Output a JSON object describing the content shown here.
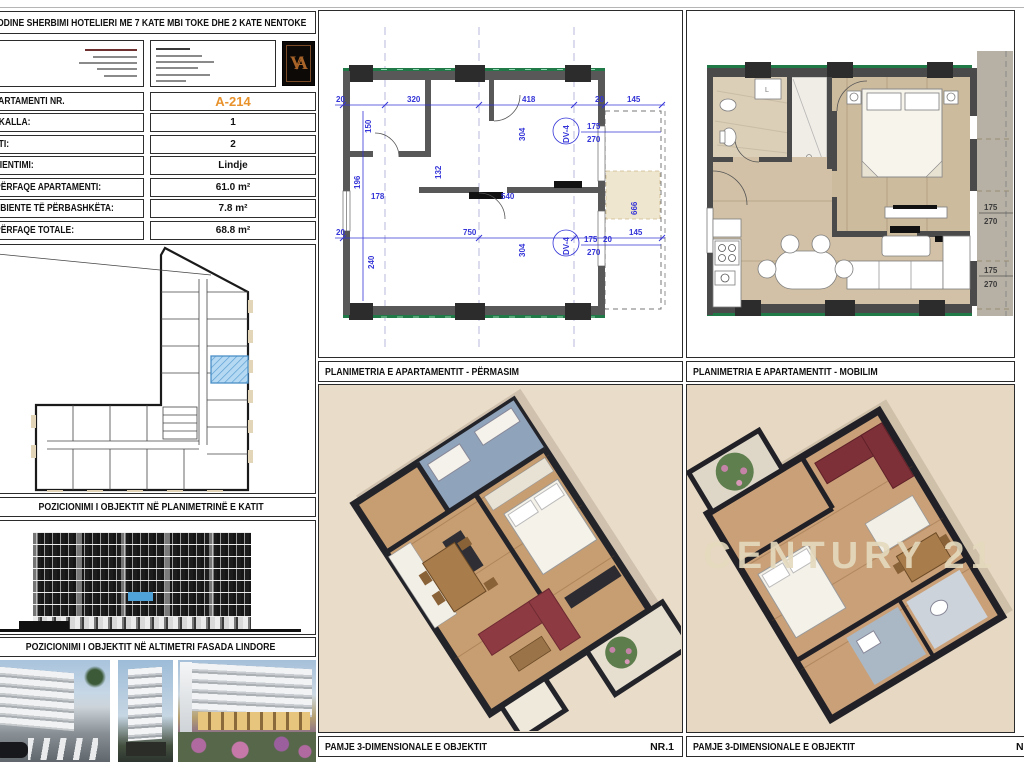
{
  "sheet": {
    "title": "GODINE SHERBIMI HOTELIERI ME 7 KATE MBI TOKE DHE 2 KATE NENTOKE",
    "logo_monogram": "VA",
    "accent_orange": "#e8922c",
    "highlight_blue": "#a9d3ef",
    "dimension_blue": "#3434d8",
    "beam_green": "#1f7a47"
  },
  "apartment_table": {
    "rows": [
      {
        "label": "APARTAMENTI NR.",
        "value": "A-214"
      },
      {
        "label": "SHKALLA:",
        "value": "1"
      },
      {
        "label": "KATI:",
        "value": "2"
      },
      {
        "label": "ORIENTIMI:",
        "value": "Lindje"
      },
      {
        "label": "SIPËRFAQE APARTAMENTI:",
        "value": "61.0 m²"
      },
      {
        "label": "AMBIENTE TË PËRBASHKËTA:",
        "value": "7.8 m²"
      },
      {
        "label": "SIPËRFAQE TOTALE:",
        "value": "68.8 m²"
      }
    ]
  },
  "captions": {
    "key_plan": "POZICIONIMI I OBJEKTIT NË PLANIMETRINË E KATIT",
    "elevation": "POZICIONIMI I OBJEKTIT NË ALTIMETRI FASADA  LINDORE",
    "plan_dimensions": "PLANIMETRIA E APARTAMENTIT - PËRMASIM",
    "plan_furnished": "PLANIMETRIA E APARTAMENTIT - MOBILIM",
    "view3d_left": "PAMJE 3-DIMENSIONALE E OBJEKTIT",
    "view3d_left_no": "NR.1",
    "view3d_right": "PAMJE 3-DIMENSIONALE E OBJEKTIT",
    "view3d_right_no": "NR.2"
  },
  "watermark": "CENTURY 21",
  "mid_dims": [
    "20",
    "320",
    "418",
    "20",
    "145",
    "150",
    "304",
    "DV-4",
    "175",
    "270",
    "132",
    "196",
    "178",
    "540",
    "750",
    "304",
    "240",
    "DV-4",
    "175",
    "270",
    "20",
    "145",
    "666",
    "20"
  ],
  "furn_dims": [
    "175",
    "270",
    "175",
    "270"
  ]
}
